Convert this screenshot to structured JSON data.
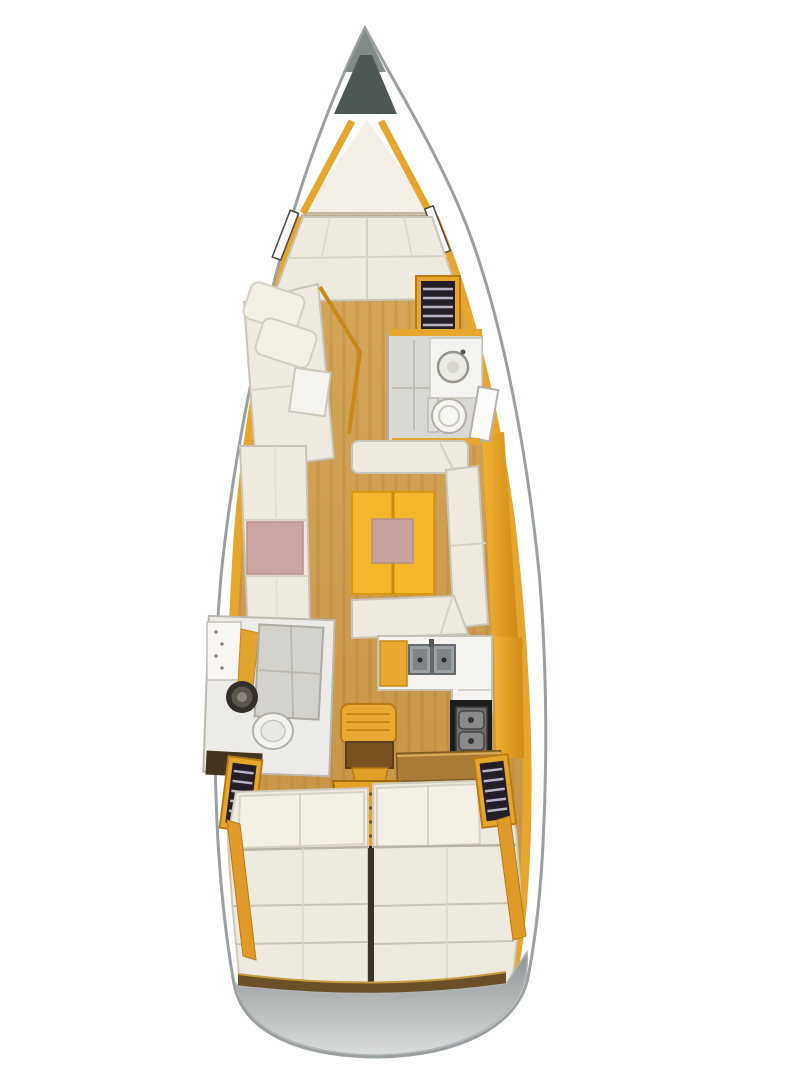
{
  "diagram": {
    "kind": "sailing-yacht-interior-floorplan",
    "view": "top-down",
    "parts": [
      {
        "name": "anchor-locker"
      },
      {
        "name": "forepeak-sail-locker"
      },
      {
        "name": "v-berth-forward-cabin"
      },
      {
        "name": "forward-bench-with-pillows"
      },
      {
        "name": "forward-hanging-locker"
      },
      {
        "name": "forward-head-bathroom"
      },
      {
        "name": "salon-port-settee"
      },
      {
        "name": "salon-u-settee"
      },
      {
        "name": "salon-table"
      },
      {
        "name": "tv-unit"
      },
      {
        "name": "galley-double-sink"
      },
      {
        "name": "galley-stove"
      },
      {
        "name": "nav-seat"
      },
      {
        "name": "chart-table"
      },
      {
        "name": "companionway-steps"
      },
      {
        "name": "aft-head-bathroom"
      },
      {
        "name": "aft-cabin-port-berth"
      },
      {
        "name": "aft-cabin-starboard-berth"
      },
      {
        "name": "aft-hanging-lockers"
      },
      {
        "name": "stern-swim-platform"
      }
    ]
  },
  "palette": {
    "background": "#ffffff",
    "hull_outline": "#9aa0a2",
    "hull_fill": "#ffffff",
    "bow_tip": "#818a89",
    "anchor_locker": "#4d5854",
    "forepeak_white": "#f3efe6",
    "floor_wood": "#d4a85c",
    "floor_wood_dark": "#c59144",
    "grain_line": "#8c550f",
    "trim_amber": "#e6a52c",
    "trim_amber_dark": "#c9881a",
    "cushion_cream": "#efeae0",
    "cushion_stroke": "#c9c4b8",
    "pillow": "#f4f0e6",
    "seam_gray": "#b9b3a5",
    "table_yellow": "#f4b62a",
    "table_edge": "#c8860a",
    "table_inlay_pink": "#c9a29e",
    "bench_panel_pink": "#cba6a4",
    "wet_room_gray": "#d9d8d3",
    "shower_gray": "#d3d2cc",
    "counter_white": "#f4f3ef",
    "sink_steel": "#9aa0a4",
    "sink_steel_dark": "#7e8488",
    "stove_dark": "#1c1c1c",
    "stove_panel": "#6e6e6e",
    "burner_gray": "#8a8a8a",
    "locker_dark": "#241f26",
    "hanger_stripe": "#b8b4c6",
    "chart_table_wood": "#a87c36",
    "seat_brown": "#7a5220",
    "steps_amber": "#e8a326",
    "steps_edge": "#a06c0e",
    "transom_wood": "#6b4f28",
    "transom_wood_edge": "#c89a40",
    "platform_gray_top": "#8e9294",
    "platform_gray_bottom": "#dadddc",
    "tv_black": "#151515",
    "divider_dark": "#3a3228",
    "dark_sink_ring": "#332e29",
    "dark_sink_mid": "#5c554e",
    "dark_sink_center": "#8d847b",
    "dark_cabinet": "#44351f",
    "window_slot": "#fafafa",
    "window_slot_edge": "#4a4a4a"
  }
}
